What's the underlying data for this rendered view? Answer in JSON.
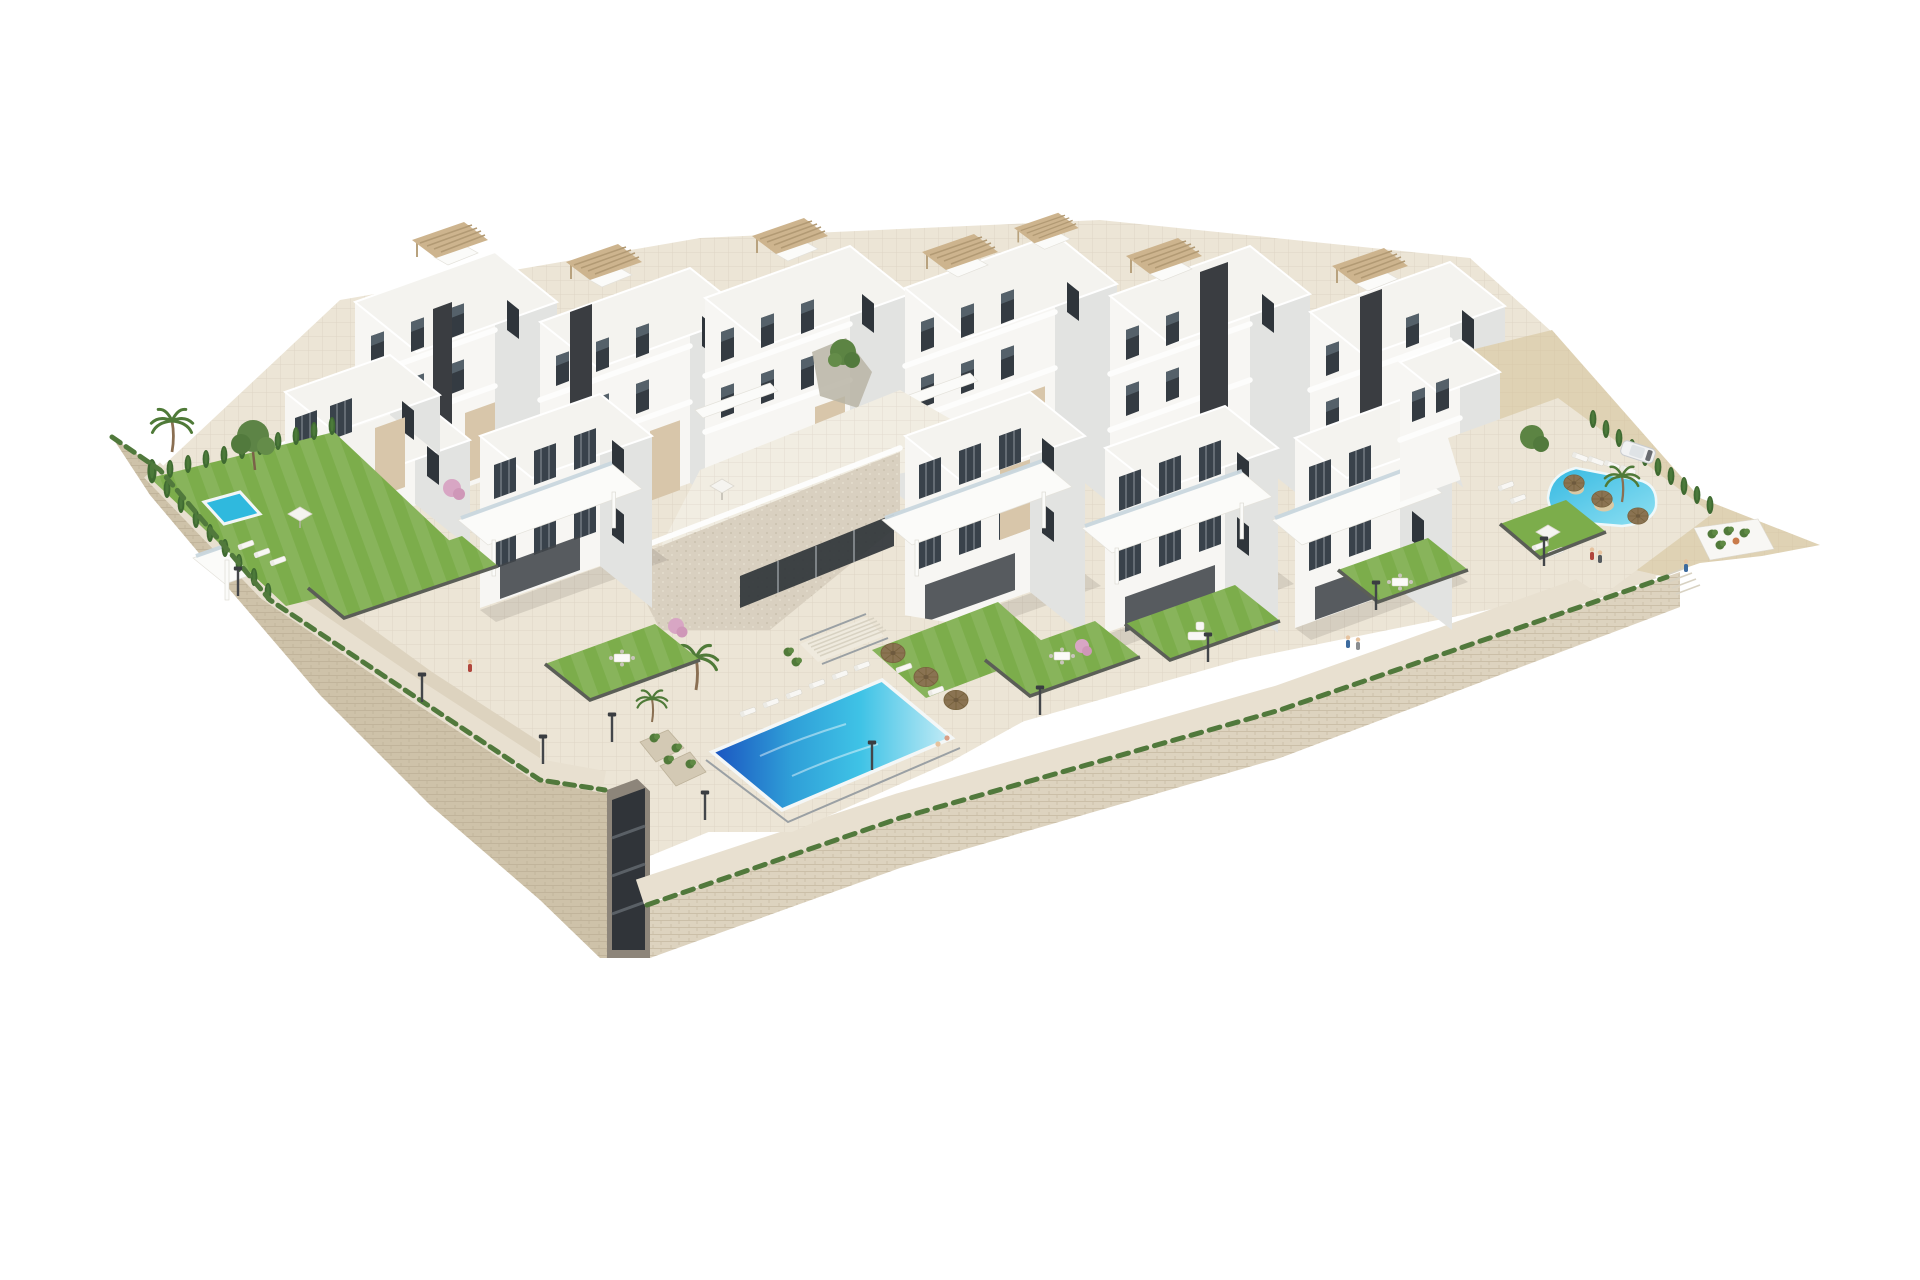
{
  "meta": {
    "title": "Aerial 3D architectural rendering of a modern white hillside apartment complex",
    "type": "architectural_visualization",
    "setting": "complex isolated on a pure white background",
    "camera": "high-angle aerial axonometric view from the south-west"
  },
  "palette": {
    "background": "#ffffff",
    "building_white": "#f7f6f3",
    "building_face_shade": "#e2e3e1",
    "roof": "#f4f3ef",
    "accent_beige": "#d8c6aa",
    "accent_beige_dark": "#cdb796",
    "stair_core_dark": "#3a3d41",
    "window_glass": "#343b42",
    "glass_balustrade": "#c9d7de",
    "stone_wall": "#ddd3bf",
    "stone_wall_shade": "#cec2a9",
    "paving": "#ece5d6",
    "path": "#e8e0d0",
    "plaza": "#f1ede2",
    "travertine": "#d9d0c0",
    "lawn": "#7cad4b",
    "lawn_shade": "#68973f",
    "hedge": "#3f6a31",
    "tree": "#5c8443",
    "pool_deep": "#1a53c0",
    "pool_mid": "#2f9fd8",
    "pool_cyan": "#3fc3e6",
    "pool_pale": "#c6ecf6",
    "small_pool": "#2fb9de",
    "lagoon": "#45c6e6",
    "sand": "#dfd2b4",
    "straw_umbrella": "#8a7352",
    "white_furniture": "#f8f7f4",
    "lamp_post": "#43464a",
    "car_white": "#f1f2f3",
    "pink_blossom": "#d8a6c4"
  },
  "scene": {
    "buildings": {
      "back_row_towers": 6,
      "front_row_blocks": 5,
      "stories": "3-4",
      "style": "modern cubic white volumes with beige accent panels, dark glazing, glass balustrades",
      "rooftop_pergolas": 7,
      "dark_stair_cores": 5,
      "clubhouse": "stone-clad clubhouse with glazed entrance below a central plaza"
    },
    "pools": [
      {
        "name": "private-villa-pool",
        "location": "left private garden",
        "color": "#2fb9de"
      },
      {
        "name": "communal-pool",
        "location": "central lower terrace with lounger deck",
        "color": "deep blue to pale cyan"
      },
      {
        "name": "lagoon-pool",
        "location": "right terrace",
        "color": "#45c6e6",
        "features": "sand islands with straw umbrellas"
      }
    ],
    "amenities": {
      "sun_loungers": 20,
      "straw_umbrellas": 6,
      "white_parasols": 3,
      "central_staircase": true,
      "promenade_lamp_posts": 10,
      "underground_garage_entrance": true,
      "stone_retaining_walls": true
    },
    "landscaping": {
      "private_lawn_gardens": 7,
      "cypress_hedges": 2,
      "palm_trees": 5,
      "pine_trees": 3,
      "flowering_pink_trees": 3,
      "grass_tufts_on_wall_tops": true
    },
    "vehicles": {
      "white_car_parked": 1
    },
    "people": {
      "walking": 6,
      "swimming": 2
    }
  }
}
